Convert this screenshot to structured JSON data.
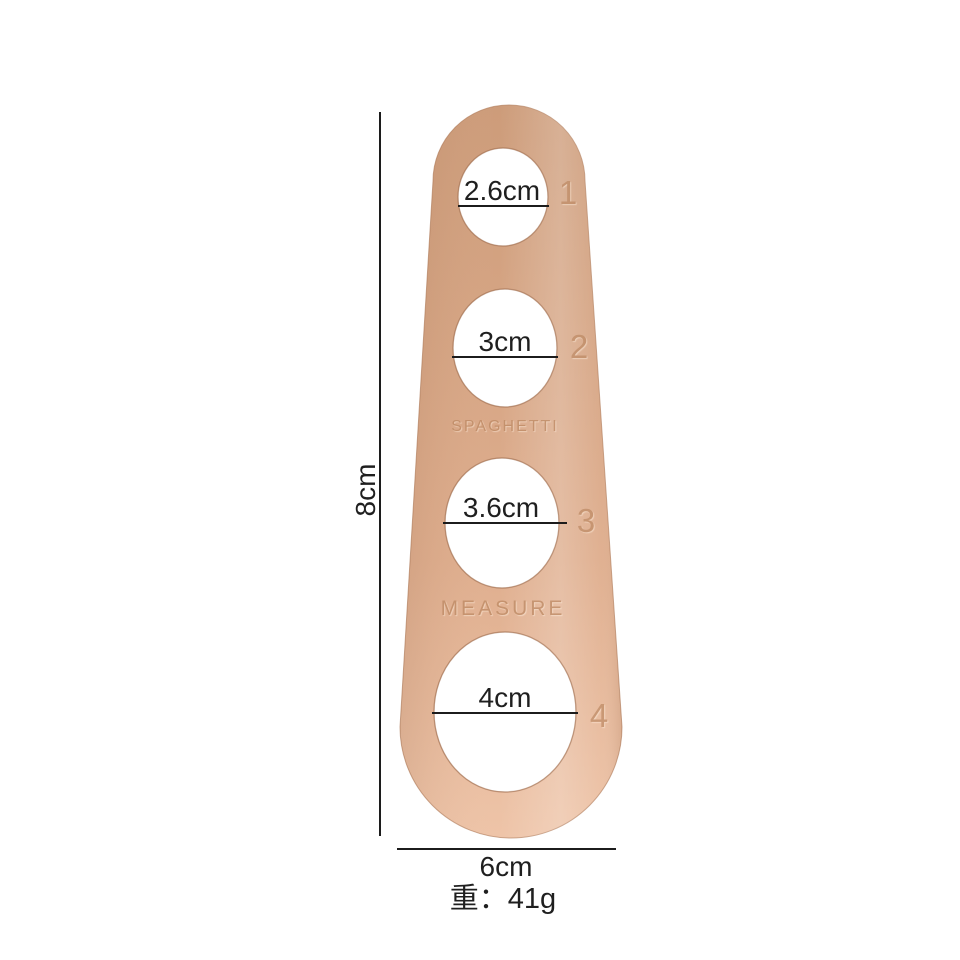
{
  "product": {
    "name": "spaghetti measuring tool",
    "engraving_top": "SPAGHETTI",
    "engraving_bottom": "MEASURE",
    "holes": [
      {
        "diameter": "2.6cm",
        "number": "1"
      },
      {
        "diameter": "3cm",
        "number": "2"
      },
      {
        "diameter": "3.6cm",
        "number": "3"
      },
      {
        "diameter": "4cm",
        "number": "4"
      }
    ],
    "colors": {
      "body_top": "#cd9c7a",
      "body_bottom": "#eec4a8",
      "engraving": "#bd8963",
      "hole_fill": "#ffffff"
    }
  },
  "annotations": {
    "height": "8cm",
    "width": "6cm",
    "weight": "重：41g",
    "line_color": "#1c1c1c",
    "text_color": "#1f1f1f"
  }
}
